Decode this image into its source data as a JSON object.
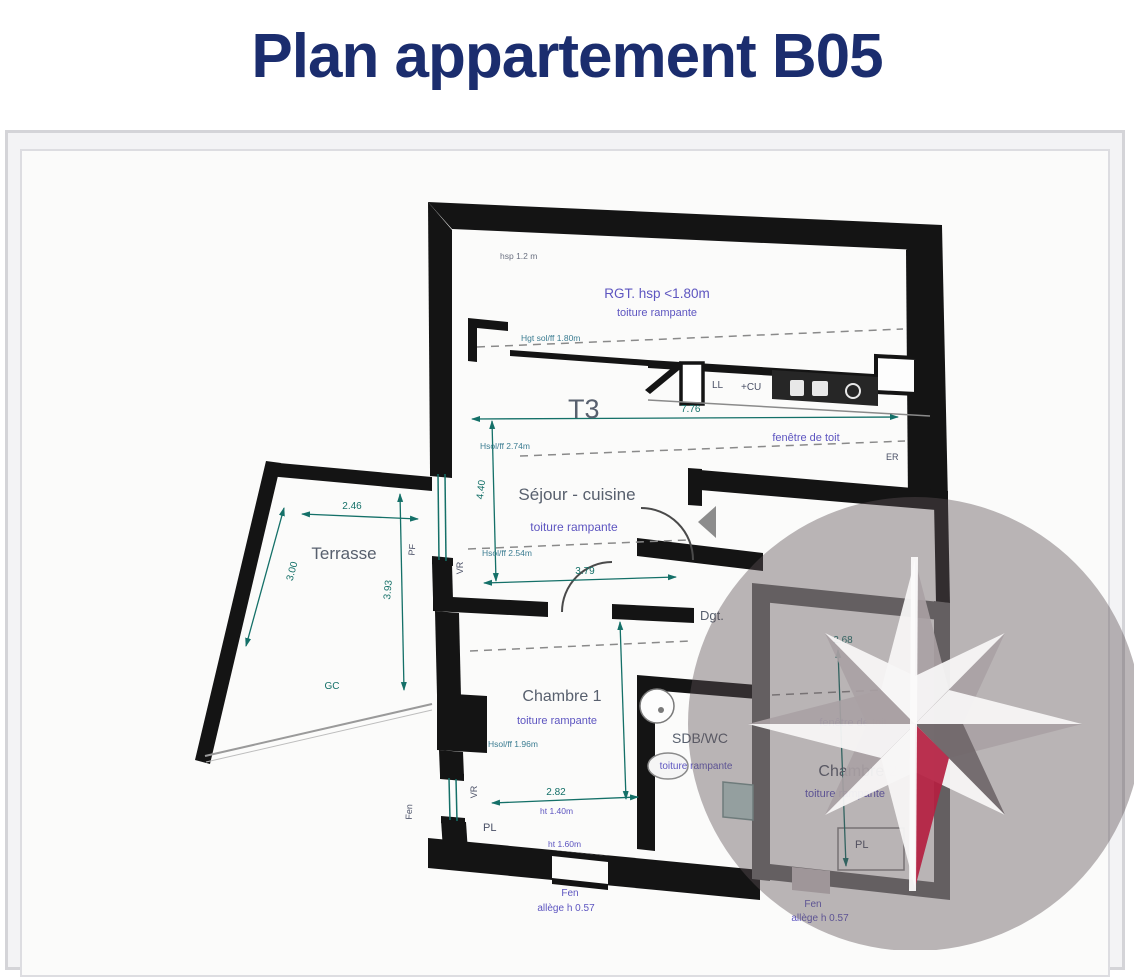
{
  "header": {
    "title": "Plan appartement B05"
  },
  "plan": {
    "unit_type": "T3",
    "rooms": {
      "rgt": {
        "name": "RGT. hsp <1.80m",
        "roof": "toiture rampante"
      },
      "sejour": {
        "name": "Séjour - cuisine",
        "roof": "toiture rampante"
      },
      "terrasse": {
        "name": "Terrasse"
      },
      "chambre1": {
        "name": "Chambre 1",
        "roof": "toiture rampante"
      },
      "sdb": {
        "name": "SDB/WC",
        "roof": "toiture rampante"
      },
      "chambre2": {
        "name": "Chambre 2",
        "roof": "toiture rampante"
      },
      "degagement": {
        "name": "Dgt."
      }
    },
    "dimensions": {
      "t3_width": "7.76",
      "sejour_width": "3.79",
      "sejour_depth": "4.40",
      "terrasse_width": "2.46",
      "terrasse_side": "3.00",
      "terrasse_depth": "3.93",
      "chambre1_width": "2.82",
      "chambre2_width": "2.68"
    },
    "annotations": {
      "hsp_note": "hsp 1.2 m",
      "hgt_sol": "Hgt sol/ff 1.80m",
      "hsol_274": "Hsol/ff 2.74m",
      "hsol_254": "Hsol/ff 2.54m",
      "hsol_196": "Hsol/ff 1.96m",
      "ht_140": "ht 1.40m",
      "ht_160": "ht 1.60m",
      "roof_window": "fenêtre de toit",
      "window": "Fen",
      "sill": "allège h 0.57"
    },
    "tags": {
      "ll": "LL",
      "cu": "+CU",
      "er": "ER",
      "pf": "PF",
      "vr": "VR",
      "pl": "PL",
      "gc": "GC"
    }
  },
  "compass": {
    "icon": "compass-rose",
    "needle_color": "#b41f41"
  },
  "colors": {
    "title": "#1b2d6e",
    "walls": "#141414",
    "dimension": "#147068",
    "roof_note": "#5d55c0",
    "room_label": "#58606e",
    "overlay": "rgba(92,82,85,0.42)"
  }
}
